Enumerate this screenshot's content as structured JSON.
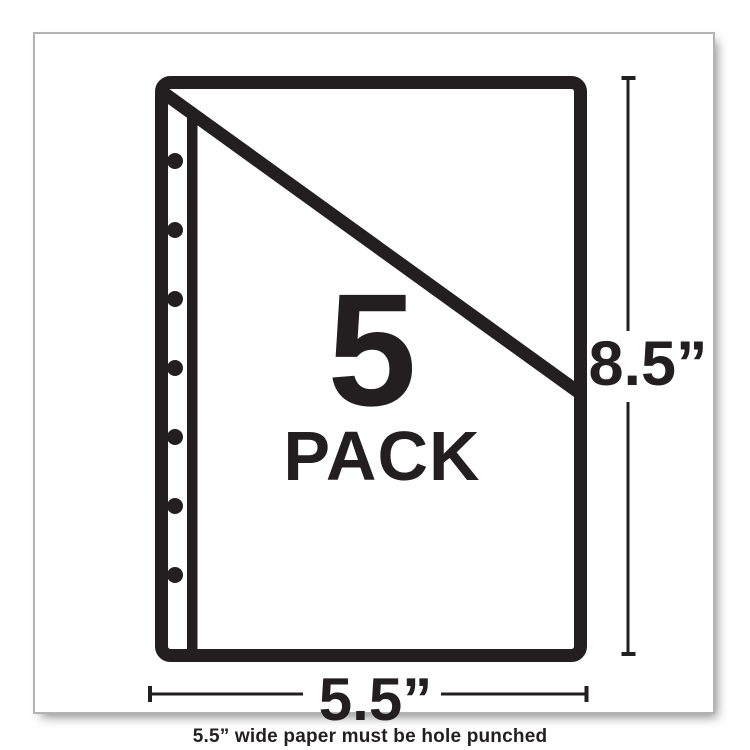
{
  "colors": {
    "ink": "#231f20",
    "card-border": "#b3b3b3",
    "background": "#ffffff"
  },
  "product_card": {
    "pack_count": "5",
    "pack_word": "PACK",
    "height_dimension_label": "8.5”",
    "width_dimension_label": "5.5”",
    "footnote": "5.5” wide paper must be hole punched",
    "graphic": {
      "name": "sheet-protector-with-diagonal-flap-and-binder-holes",
      "holes": {
        "count": 7,
        "x": 140,
        "first_y": 127,
        "spacing_y": 69,
        "radius": 8
      }
    }
  }
}
